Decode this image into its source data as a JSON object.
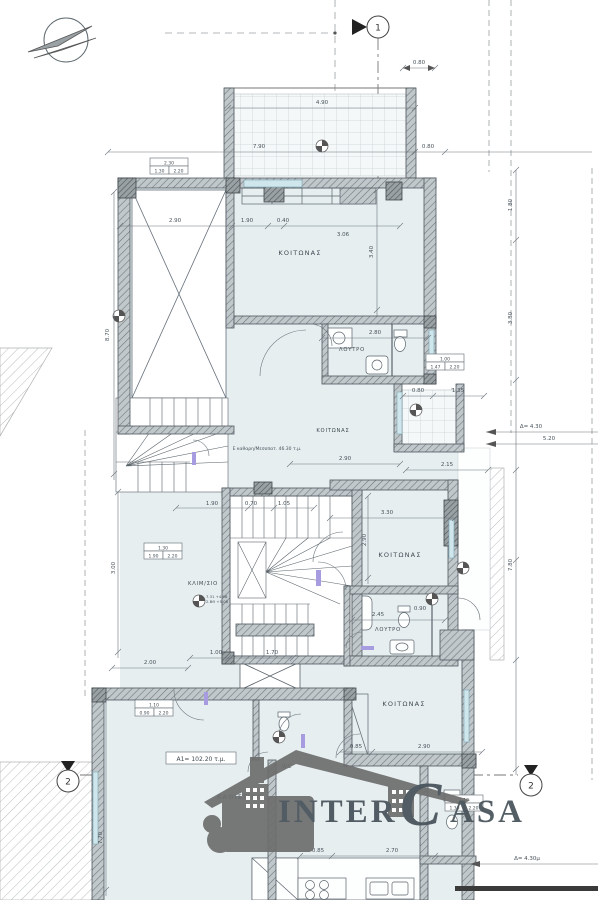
{
  "axes": {
    "axis_1": "1",
    "axis_2_left": "2",
    "axis_2_right": "2"
  },
  "rooms": {
    "bedroom_top": "ΚΟΙΤΩΝΑΣ",
    "bath_top": "ΛΟΥΤΡΟ",
    "bedroom_mid_upper": "ΚΟΙΤΩΝΑΣ",
    "bedroom_mid": "ΚΟΙΤΩΝΑΣ",
    "bath_mid": "ΛΟΥΤΡΟ",
    "bedroom_bottom": "ΚΟΙΤΩΝΑΣ",
    "living": "ΚΑΘΙΣΤΙΚΟ",
    "stairwell": "ΚΛΙΜ/ΣΙΟ",
    "wc": "WC"
  },
  "annotations": {
    "area_a1": "A1= 102.20 τ.μ.",
    "area_mezzanine": "Ε καθαρη/Μεσοπατ. 46.30 τ.μ.",
    "level_1": "7.31 +4.98",
    "level_2": "Σ.ΒΘ +5.08",
    "delta_mid": "Δ= 4.30",
    "dist_520": "5.20",
    "delta_low": "Δ= 4.30μ"
  },
  "dims": {
    "d01": "0.80",
    "d02": "4.90",
    "d03": "7.90",
    "d04": "0.80",
    "d05": "2.90",
    "d06": "1.90",
    "d07": "0.40",
    "d08": "3.06",
    "d09": "3.40",
    "d10": "2.80",
    "d11": "0.80",
    "d12": "1.35",
    "d13": "2.90",
    "d14": "2.15",
    "d17": "3.30",
    "d18": "2.90",
    "d19": "1.90",
    "d20": "0.70",
    "d21": "1.05",
    "d22": "2.45",
    "d23": "0.90",
    "d24": "1.00",
    "d25": "1.70",
    "d26": "2.00",
    "d27": "8.70",
    "d28": "3.00",
    "d29": "0.85",
    "d30": "2.90",
    "d31": "7.70",
    "d32": "0.85",
    "d33": "2.70",
    "d34": "1.80",
    "d35": "3.80",
    "d36": "7.80"
  },
  "dim_boxes": [
    {
      "top": "2.30",
      "a": "1.30",
      "b": "2.20"
    },
    {
      "top": "1.30",
      "a": "1.90",
      "b": "2.20"
    },
    {
      "top": "1.10",
      "a": "0.90",
      "b": "2.20"
    },
    {
      "top": "1.00",
      "a": "1.47",
      "b": "2.20"
    },
    {
      "top": "1.10",
      "a": "1.30",
      "b": "2.20"
    }
  ],
  "logo": {
    "inter": "INTER",
    "c": "C",
    "asa": "ASA"
  },
  "colors": {
    "logo_red": "#dc4f58",
    "logo_gray": "#6e6e6e",
    "room_fill": "#e6eef0",
    "line": "#5f6a70"
  }
}
